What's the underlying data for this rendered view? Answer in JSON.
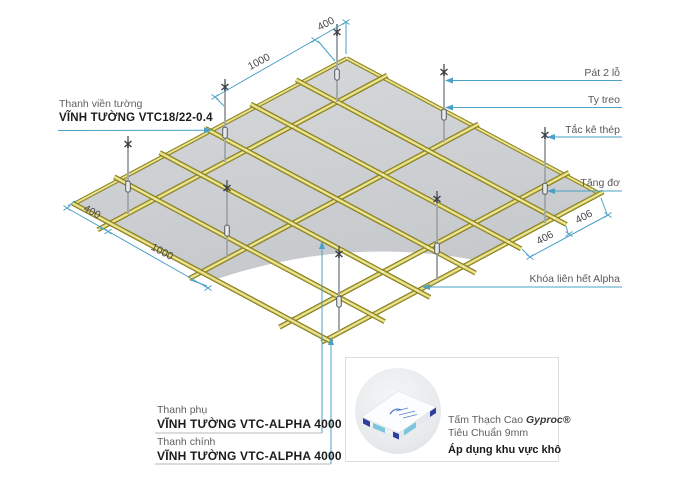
{
  "diagram": {
    "labels": {
      "wall_angle_type": "Thanh viền tường",
      "wall_angle_product": "VĨNH TƯỜNG VTC18/22-0.4",
      "bracket": "Pát 2 lỗ",
      "hanger_rod": "Ty treo",
      "steel_anchor": "Tắc kê thép",
      "turnbuckle": "Tăng đơ",
      "alpha_lock": "Khóa liên hết Alpha",
      "cross_tee_type": "Thanh phụ",
      "cross_tee_product": "VĨNH TƯỜNG VTC-ALPHA 4000",
      "main_runner_type": "Thanh chính",
      "main_runner_product": "VĨNH TƯỜNG VTC-ALPHA 4000"
    },
    "dimensions": {
      "top": {
        "first": "1000",
        "second": "400"
      },
      "lower_left": {
        "first": "400",
        "second": "1000"
      },
      "lower_right": {
        "first": "406",
        "second": "406"
      }
    },
    "board_note": {
      "material_prefix": "Tấm Thạch Cao ",
      "brand": "Gyproc®",
      "spec": "Tiêu Chuẩn 9mm",
      "usage": "Áp dụng khu vực khô"
    },
    "colors": {
      "bar_dark": "#7f7823",
      "bar_mid": "#cfc24b",
      "bar_light": "#f1ecae",
      "panel_top": "#d6d8da",
      "panel_bottom": "#c7cacd",
      "leader": "#4aa0c6",
      "underline_gray": "#b4babe",
      "rod": "#8b9095",
      "rod_dark": "#3c4046",
      "board_blue_dark": "#2e3f9e",
      "board_blue_light": "#7cc5df"
    }
  }
}
